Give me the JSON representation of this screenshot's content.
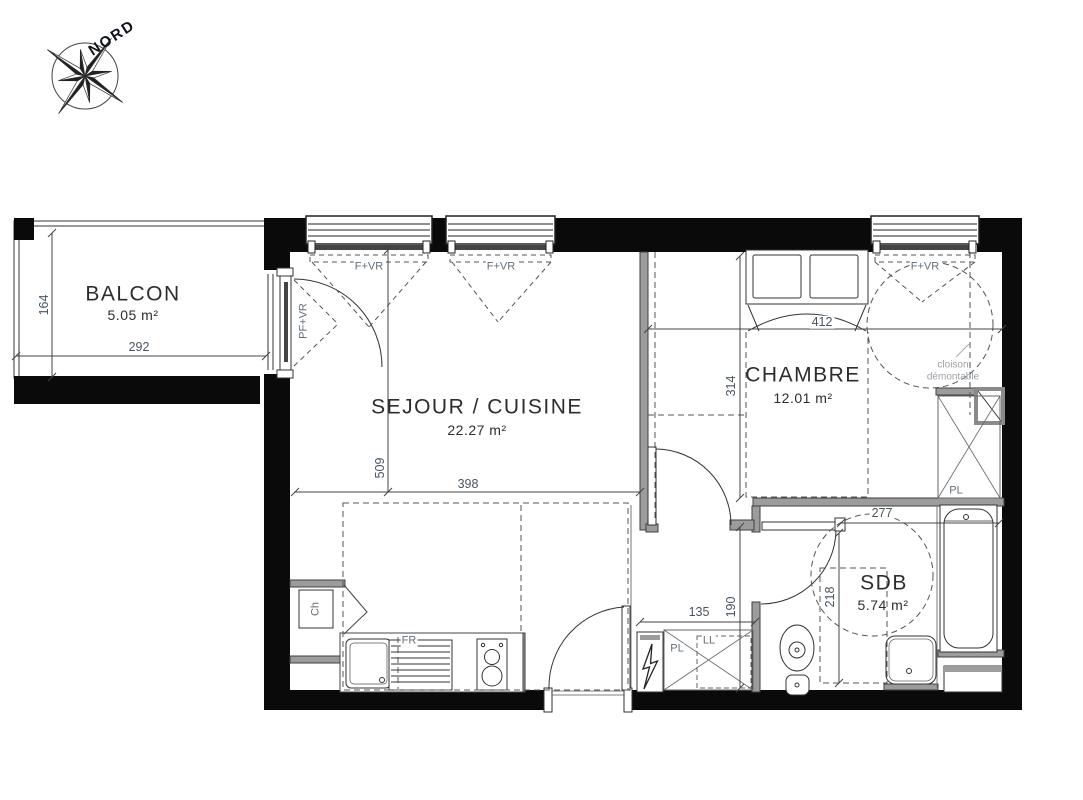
{
  "compass": {
    "north_label": "NORD"
  },
  "rooms": {
    "balcon": {
      "name": "BALCON",
      "area": "5.05 m²"
    },
    "sejour_cuisine": {
      "name": "SEJOUR / CUISINE",
      "area": "22.27 m²"
    },
    "chambre": {
      "name": "CHAMBRE",
      "area": "12.01 m²"
    },
    "sdb": {
      "name": "SDB",
      "area": "5.74 m²"
    }
  },
  "dimensions_cm": {
    "balcon_depth": "164",
    "balcon_width": "292",
    "sejour_depth": "509",
    "sejour_width": "398",
    "chambre_width": "412",
    "chambre_depth": "314",
    "sdb_width": "277",
    "sdb_depth": "218",
    "entry_width": "135",
    "entry_depth": "190"
  },
  "openings": {
    "window_1": "F+VR",
    "window_2": "F+VR",
    "window_3": "F+VR",
    "balcony_door": "PF+VR"
  },
  "fixtures": {
    "boiler": "Ch",
    "fridge": "FR",
    "entry_closet": "PL",
    "washing_machine": "LL",
    "bedroom_closet": "PL"
  },
  "annotations": {
    "removable_partition": "cloison démontable"
  },
  "colors": {
    "exterior_wall": "#0a0a0a",
    "interior_wall": "#9c9c9c",
    "dashed_lines": "#555555",
    "dimension_text": "#47555f",
    "note_text": "#9aa0a6"
  }
}
